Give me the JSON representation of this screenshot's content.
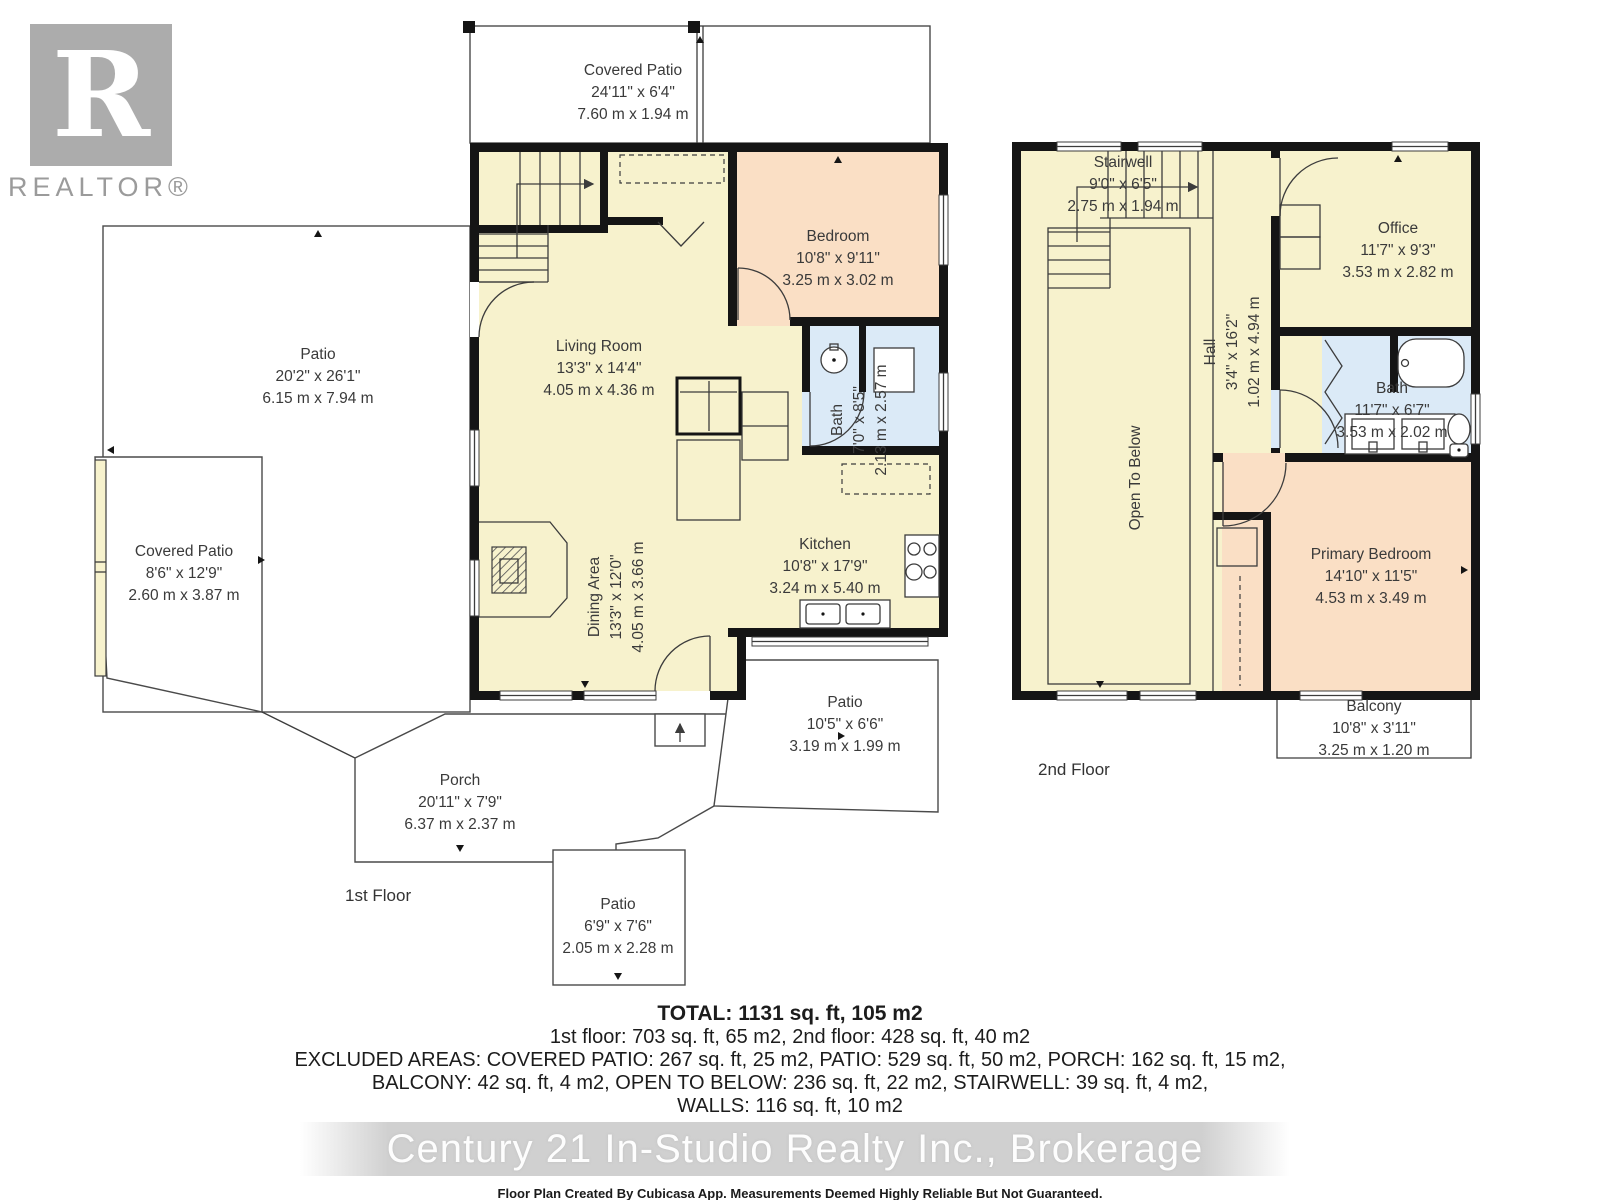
{
  "branding": {
    "logo_text": "R",
    "logo_label": "REALTOR®"
  },
  "floors": {
    "first": {
      "label": "1st Floor",
      "rooms": {
        "covered_patio_top": {
          "name": "Covered Patio",
          "imperial": "24'11\" x 6'4\"",
          "metric": "7.60 m x 1.94 m"
        },
        "patio_left": {
          "name": "Patio",
          "imperial": "20'2\" x 26'1\"",
          "metric": "6.15 m x 7.94 m"
        },
        "covered_patio_left": {
          "name": "Covered Patio",
          "imperial": "8'6\" x 12'9\"",
          "metric": "2.60 m x 3.87 m"
        },
        "living_room": {
          "name": "Living Room",
          "imperial": "13'3\" x 14'4\"",
          "metric": "4.05 m x 4.36 m"
        },
        "bedroom": {
          "name": "Bedroom",
          "imperial": "10'8\" x 9'11\"",
          "metric": "3.25 m x 3.02 m"
        },
        "bath": {
          "name": "Bath",
          "imperial": "7'0\" x 8'5\"",
          "metric": "2.13 m x 2.57 m"
        },
        "kitchen": {
          "name": "Kitchen",
          "imperial": "10'8\" x 17'9\"",
          "metric": "3.24 m x 5.40 m"
        },
        "dining": {
          "name": "Dining Area",
          "imperial": "13'3\" x 12'0\"",
          "metric": "4.05 m x 3.66 m"
        },
        "patio_right": {
          "name": "Patio",
          "imperial": "10'5\" x 6'6\"",
          "metric": "3.19 m x 1.99 m"
        },
        "porch": {
          "name": "Porch",
          "imperial": "20'11\" x 7'9\"",
          "metric": "6.37 m x 2.37 m"
        },
        "patio_bottom": {
          "name": "Patio",
          "imperial": "6'9\" x 7'6\"",
          "metric": "2.05 m x 2.28 m"
        }
      }
    },
    "second": {
      "label": "2nd Floor",
      "rooms": {
        "stairwell": {
          "name": "Stairwell",
          "imperial": "9'0\" x 6'5\"",
          "metric": "2.75 m x 1.94 m"
        },
        "office": {
          "name": "Office",
          "imperial": "11'7\" x 9'3\"",
          "metric": "3.53 m x 2.82 m"
        },
        "hall": {
          "name": "Hall",
          "imperial": "3'4\" x 16'2\"",
          "metric": "1.02 m x 4.94 m"
        },
        "open_to_below": {
          "name": "Open To Below"
        },
        "bath": {
          "name": "Bath",
          "imperial": "11'7\" x 6'7\"",
          "metric": "3.53 m x 2.02 m"
        },
        "primary_bedroom": {
          "name": "Primary Bedroom",
          "imperial": "14'10\" x 11'5\"",
          "metric": "4.53 m x 3.49 m"
        },
        "balcony": {
          "name": "Balcony",
          "imperial": "10'8\" x 3'11\"",
          "metric": "3.25 m x 1.20 m"
        }
      }
    }
  },
  "summary": {
    "total": "TOTAL: 1131 sq. ft, 105 m2",
    "line2": "1st floor: 703 sq. ft, 65 m2, 2nd floor: 428 sq. ft, 40 m2",
    "line3": "EXCLUDED AREAS: COVERED PATIO: 267 sq. ft, 25 m2, PATIO: 529 sq. ft, 50 m2, PORCH: 162 sq. ft, 15 m2,",
    "line4": "BALCONY: 42 sq. ft, 4 m2, OPEN TO BELOW: 236 sq. ft, 22 m2, STAIRWELL: 39 sq. ft, 4 m2,",
    "line5": "WALLS: 116 sq. ft, 10 m2"
  },
  "watermark": "Century 21 In-Studio Realty Inc., Brokerage",
  "disclaimer": "Floor Plan Created By Cubicasa App. Measurements Deemed Highly Reliable But Not Guaranteed.",
  "colors": {
    "room": "#F7F2CD",
    "bedroom": "#FADFC5",
    "bath": "#DBEAF7",
    "wall": "#151515"
  }
}
